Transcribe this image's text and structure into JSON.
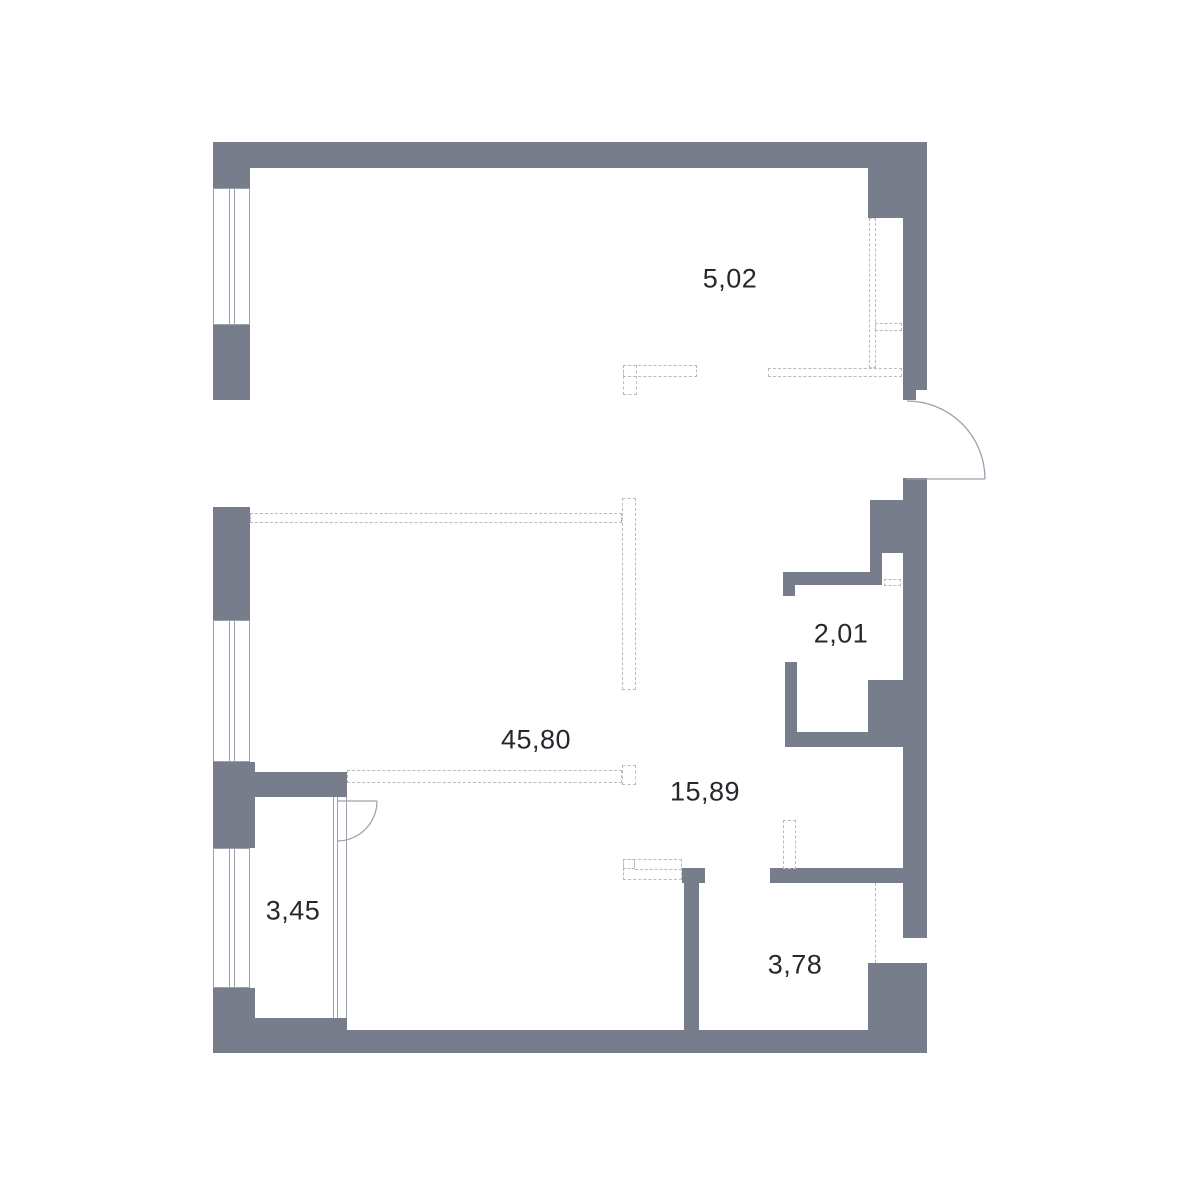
{
  "plan": {
    "rooms": [
      {
        "area": "5,02"
      },
      {
        "area": "2,01"
      },
      {
        "area": "45,80"
      },
      {
        "area": "15,89"
      },
      {
        "area": "3,45"
      },
      {
        "area": "3,78"
      }
    ],
    "colors": {
      "wall": "#787d8c",
      "dashed_outline": "#b7bbc3",
      "thin_line": "#9aa0ad",
      "text": "#26282e",
      "background": "#ffffff"
    }
  }
}
